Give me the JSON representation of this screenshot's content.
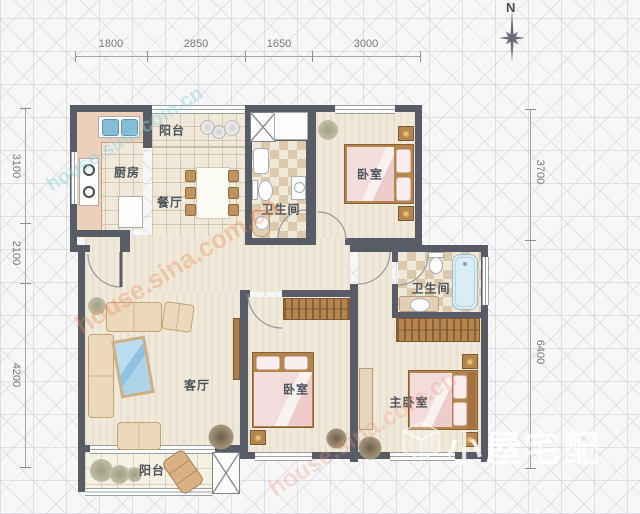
{
  "meta": {
    "compass": "N"
  },
  "rooms": {
    "balcony_top": "阳台",
    "kitchen": "厨房",
    "dining": "餐厅",
    "bath1": "卫生间",
    "bedroom_top": "卧室",
    "living": "客厅",
    "bedroom_mid": "卧室",
    "bath2": "卫生间",
    "master": "主卧室",
    "balcony_bottom": "阳台"
  },
  "dimensions": {
    "top": [
      "1800",
      "2850",
      "1650",
      "3000"
    ],
    "left": [
      "3100",
      "2100",
      "4200"
    ],
    "right": [
      "3700",
      "6400"
    ]
  },
  "watermarks": {
    "site": "house.sina.com.cn",
    "logo": "小屋宅配"
  },
  "colors": {
    "wall": "#575c66",
    "floor_stripe": "#f0e9da",
    "tile": "#f0e9d9",
    "checker_dark": "#dcc9ab",
    "bed_pink": "#f2d9d9",
    "wood": "#b5854e",
    "coffee_table_blue": "#a9cfe6",
    "bathtub_blue": "#d9edf5",
    "watermark_orange": "#e68c50"
  }
}
